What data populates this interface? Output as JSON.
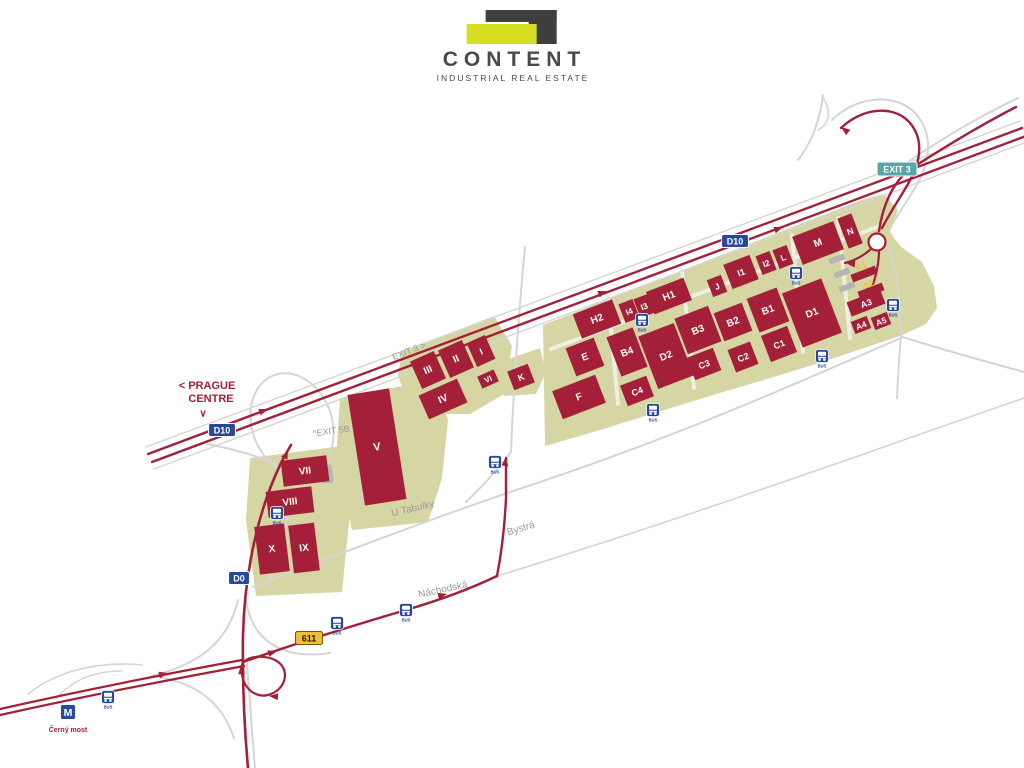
{
  "logo": {
    "title": "CONTENT",
    "subtitle": "INDUSTRIAL REAL ESTATE"
  },
  "colors": {
    "brick": "#a32038",
    "olive": "#d6d5a4",
    "road_gray": "#d5d5d5",
    "road_inner": "#efeee1",
    "blue": "#27499b",
    "teal": "#55a8a8",
    "badge_yellow": "#f3bf30",
    "label_yellow": "#eec43e",
    "gray_building": "#b5b5b5",
    "text_gray": "#9b9b9b",
    "logo_yellow": "#d7df23",
    "logo_dark": "#3f3f3f",
    "text_dark": "#4a4a4a",
    "white": "#ffffff"
  },
  "map": {
    "bus_label": "BUS",
    "parcels": [
      {
        "id": "east-campus",
        "points": "543,325 660,279 780,232 862,200 884,194 898,210 890,232 900,246 922,262 934,286 937,308 926,324 900,336 810,366 690,402 600,430 545,446"
      },
      {
        "id": "k-parcel",
        "points": "500,362 540,348 546,372 536,394 504,396"
      },
      {
        "id": "west-parcel-1",
        "points": "402,352 494,316 512,346 504,394 470,414 412,414 398,376"
      },
      {
        "id": "west-parcel-v",
        "points": "340,398 434,380 448,420 442,478 428,522 352,530 336,460"
      },
      {
        "id": "west-parcel-2",
        "points": "250,458 342,446 350,512 342,592 256,596 246,520"
      }
    ],
    "roads": [
      {
        "id": "campus-inner-1",
        "c": "inner",
        "w": 4,
        "d": "M 551,349 L 880,226"
      },
      {
        "id": "campus-inner-2",
        "c": "inner",
        "w": 4,
        "d": "M 608,297 L 618,404"
      },
      {
        "id": "campus-inner-3",
        "c": "inner",
        "w": 4,
        "d": "M 682,270 L 694,388"
      },
      {
        "id": "campus-inner-4",
        "c": "inner",
        "w": 4,
        "d": "M 792,235 L 803,352"
      },
      {
        "id": "campus-inner-5",
        "c": "inner",
        "w": 4,
        "d": "M 838,218 L 850,338"
      },
      {
        "id": "d10-edge-n",
        "c": "gray",
        "w": 1.4,
        "d": "M 146,447 L 1020,121"
      },
      {
        "id": "d10-edge-s",
        "c": "gray",
        "w": 1.4,
        "d": "M 154,469 L 1024,143"
      },
      {
        "id": "u-tabulky",
        "c": "gray",
        "w": 2,
        "d": "M 253,587 C 380,538 470,505 540,482 C 680,435 800,382 903,337"
      },
      {
        "id": "u-tabulky-east",
        "c": "gray",
        "w": 2,
        "d": "M 903,337 C 943,350 984,361 1024,372"
      },
      {
        "id": "campus-south-branch",
        "c": "gray",
        "w": 2,
        "d": "M 901,336 C 899,357 898,376 897,398"
      },
      {
        "id": "nachodska-ext",
        "c": "gray",
        "w": 1.6,
        "d": "M 497,576 C 680,520 860,455 1024,398"
      },
      {
        "id": "underpass-connector",
        "c": "gray",
        "w": 2,
        "d": "M 525,247 C 518,320 513,400 511,452"
      },
      {
        "id": "junction-link",
        "c": "gray",
        "w": 2,
        "d": "M 511,452 C 497,470 481,488 466,502"
      },
      {
        "id": "west-loop",
        "c": "gray",
        "w": 2,
        "ellipse": [
          292,
          424,
          40,
          52,
          -20
        ]
      },
      {
        "id": "west-loop-south",
        "c": "gray",
        "w": 2,
        "d": "M 297,474 C 290,510 280,548 268,586"
      },
      {
        "id": "west-ramp",
        "c": "gray",
        "w": 2,
        "d": "M 207,444 C 238,450 262,457 281,467"
      },
      {
        "id": "d0-ramp-w",
        "c": "gray",
        "w": 2,
        "d": "M 238,600 C 228,642 200,664 152,676"
      },
      {
        "id": "d0-ramp-sw",
        "c": "gray",
        "w": 2,
        "d": "M 152,676 C 196,682 222,702 234,738"
      },
      {
        "id": "d0-ramp-e",
        "c": "gray",
        "w": 2,
        "d": "M 246,600 C 252,642 284,660 330,653"
      },
      {
        "id": "d0-south-edge",
        "c": "gray",
        "w": 2,
        "d": "M 247,664 C 250,700 252,734 255,768"
      },
      {
        "id": "metro-area-1",
        "c": "gray",
        "w": 1.6,
        "d": "M 28,694 C 58,670 100,661 142,665"
      },
      {
        "id": "metro-area-2",
        "c": "gray",
        "w": 1.6,
        "d": "M 56,699 C 72,680 95,671 122,671"
      },
      {
        "id": "exit3-gray-loop",
        "c": "gray",
        "w": 2,
        "d": "M 832,120 C 864,88 922,92 928,142 C 930,175 908,196 890,228"
      },
      {
        "id": "exit3-gray-ne",
        "c": "gray",
        "w": 2,
        "d": "M 1018,98 C 972,120 937,142 908,162"
      },
      {
        "id": "exit3-gray-n",
        "c": "gray",
        "w": 2,
        "d": "M 823,95 C 820,120 812,142 798,160"
      },
      {
        "id": "exit3-gray-loop2",
        "c": "gray",
        "w": 1.6,
        "d": "M 822,96 C 832,110 830,124 818,130"
      },
      {
        "id": "exit3-gray-s",
        "c": "gray",
        "w": 2,
        "d": "M 888,249 C 894,262 897,275 898,290 C 899,305 900,318 901,333"
      },
      {
        "id": "d10-north",
        "c": "red",
        "w": 2.4,
        "d": "M 148,454 L 1022,128"
      },
      {
        "id": "d10-south",
        "c": "red",
        "w": 2.4,
        "d": "M 152,462 L 1026,136"
      },
      {
        "id": "chlumecka-1",
        "c": "red",
        "w": 2.2,
        "d": "M 0,709 C 80,691 160,675 242,660"
      },
      {
        "id": "chlumecka-2",
        "c": "red",
        "w": 2.2,
        "d": "M 0,715 C 82,697 162,681 244,666"
      },
      {
        "id": "nachodska",
        "c": "red",
        "w": 2.4,
        "d": "M 243,662 C 300,642 355,625 406,610 C 440,600 468,590 497,576"
      },
      {
        "id": "bystra",
        "c": "red",
        "w": 2.4,
        "d": "M 497,576 C 503,545 505,520 506,498 L 506,458"
      },
      {
        "id": "d0-exit5b",
        "c": "red",
        "w": 2.6,
        "d": "M 248,768 C 245,735 243,700 243,662 C 242,622 245,590 251,558 C 258,520 268,490 281,463 C 285,455 288,450 291,445"
      },
      {
        "id": "loop-611",
        "c": "red",
        "w": 2.2,
        "d": "M 243,661 C 237,682 252,699 268,695 C 287,690 291,668 275,660 C 264,655 251,656 245,661"
      },
      {
        "id": "exit3-loop",
        "c": "red",
        "w": 2.4,
        "d": "M 841,128 C 867,103 908,104 918,138 C 925,168 902,190 882,228"
      },
      {
        "id": "exit3-ramp-ne",
        "c": "red",
        "w": 2.4,
        "d": "M 1016,107 C 975,128 940,150 912,168 C 897,178 884,198 879,231"
      },
      {
        "id": "campus-entry-w",
        "c": "red",
        "w": 2.2,
        "d": "M 871,249 C 862,257 853,261 845,263"
      },
      {
        "id": "campus-entry-s",
        "c": "red",
        "w": 2.2,
        "d": "M 879,251 C 879,267 874,282 869,297"
      }
    ],
    "roundabout": {
      "x": 877,
      "y": 242,
      "r": 8.5
    },
    "arrows": [
      {
        "x": 268,
        "y": 409,
        "r": -20.5
      },
      {
        "x": 607,
        "y": 291,
        "r": -20.5
      },
      {
        "x": 783,
        "y": 227,
        "r": -20.5
      },
      {
        "x": 168,
        "y": 673,
        "r": -13
      },
      {
        "x": 277,
        "y": 651,
        "r": -17
      },
      {
        "x": 447,
        "y": 594,
        "r": -14
      },
      {
        "x": 506,
        "y": 457,
        "r": -83
      },
      {
        "x": 241,
        "y": 665,
        "r": -94
      },
      {
        "x": 269,
        "y": 696,
        "r": 185
      },
      {
        "x": 288,
        "y": 450,
        "r": -66
      },
      {
        "x": 841,
        "y": 127,
        "r": 217
      },
      {
        "x": 896,
        "y": 177,
        "r": 155
      },
      {
        "x": 846,
        "y": 263,
        "r": 187
      },
      {
        "x": 869,
        "y": 297,
        "r": 99
      }
    ],
    "gray_buildings": [
      {
        "x": 327,
        "y": 474,
        "w": 11,
        "h": 18,
        "rot": -7
      },
      {
        "x": 831,
        "y": 246,
        "w": 16,
        "h": 6,
        "rot": -21
      },
      {
        "x": 837,
        "y": 259,
        "w": 16,
        "h": 6,
        "rot": -21
      },
      {
        "x": 842,
        "y": 273,
        "w": 16,
        "h": 6,
        "rot": -21
      },
      {
        "x": 847,
        "y": 287,
        "w": 16,
        "h": 6,
        "rot": -21
      }
    ],
    "buildings": [
      {
        "label": "H2",
        "x": 597,
        "y": 319,
        "w": 42,
        "h": 26,
        "rot": -21,
        "fs": 10
      },
      {
        "label": "I4",
        "x": 629,
        "y": 311,
        "w": 15,
        "h": 20,
        "rot": -21,
        "fs": 8.5
      },
      {
        "label": "I3",
        "x": 644,
        "y": 306,
        "w": 15,
        "h": 20,
        "rot": -21,
        "fs": 8.5
      },
      {
        "label": "H1",
        "x": 669,
        "y": 296,
        "w": 40,
        "h": 24,
        "rot": -21,
        "fs": 10
      },
      {
        "label": "J",
        "x": 717,
        "y": 286,
        "w": 15,
        "h": 18,
        "rot": -21,
        "fs": 8.5
      },
      {
        "label": "I1",
        "x": 741,
        "y": 272,
        "w": 28,
        "h": 26,
        "rot": -21,
        "fs": 9
      },
      {
        "label": "I2",
        "x": 766,
        "y": 263,
        "w": 15,
        "h": 20,
        "rot": -21,
        "fs": 8.5
      },
      {
        "label": "L",
        "x": 783,
        "y": 257,
        "w": 15,
        "h": 20,
        "rot": -21,
        "fs": 8.5
      },
      {
        "label": "M",
        "x": 818,
        "y": 243,
        "w": 44,
        "h": 30,
        "rot": -21,
        "fs": 10
      },
      {
        "label": "N",
        "x": 850,
        "y": 231,
        "w": 15,
        "h": 32,
        "rot": -21,
        "fs": 9
      },
      {
        "label": "E",
        "x": 585,
        "y": 357,
        "w": 30,
        "h": 30,
        "rot": -21,
        "fs": 10
      },
      {
        "label": "B4",
        "x": 627,
        "y": 352,
        "w": 28,
        "h": 42,
        "rot": -21,
        "fs": 10
      },
      {
        "label": "D2",
        "x": 666,
        "y": 356,
        "w": 38,
        "h": 56,
        "rot": -21,
        "fs": 10
      },
      {
        "label": "B3",
        "x": 698,
        "y": 330,
        "w": 36,
        "h": 38,
        "rot": -21,
        "fs": 10
      },
      {
        "label": "B2",
        "x": 733,
        "y": 322,
        "w": 30,
        "h": 30,
        "rot": -21,
        "fs": 10
      },
      {
        "label": "B1",
        "x": 768,
        "y": 310,
        "w": 32,
        "h": 36,
        "rot": -21,
        "fs": 10
      },
      {
        "label": "D1",
        "x": 812,
        "y": 313,
        "w": 42,
        "h": 58,
        "rot": -21,
        "fs": 10
      },
      {
        "label": "C4",
        "x": 637,
        "y": 391,
        "w": 28,
        "h": 22,
        "rot": -21,
        "fs": 9
      },
      {
        "label": "C3",
        "x": 704,
        "y": 364,
        "w": 28,
        "h": 24,
        "rot": -21,
        "fs": 9
      },
      {
        "label": "C2",
        "x": 743,
        "y": 357,
        "w": 24,
        "h": 24,
        "rot": -21,
        "fs": 9
      },
      {
        "label": "C1",
        "x": 779,
        "y": 344,
        "w": 28,
        "h": 28,
        "rot": -21,
        "fs": 9
      },
      {
        "label": "F",
        "x": 579,
        "y": 397,
        "w": 46,
        "h": 30,
        "rot": -21,
        "fs": 10
      },
      {
        "label": "K",
        "x": 521,
        "y": 377,
        "w": 22,
        "h": 20,
        "rot": -21,
        "fs": 9
      },
      {
        "label": "A1",
        "x": 864,
        "y": 274,
        "w": 26,
        "h": 8,
        "rot": -21,
        "fs": 9,
        "lc": "label_yellow",
        "dy": -8
      },
      {
        "label": "A2",
        "x": 871,
        "y": 291,
        "w": 26,
        "h": 8,
        "rot": -21,
        "fs": 9,
        "lc": "label_yellow",
        "dy": -7
      },
      {
        "label": "A3",
        "x": 866,
        "y": 303,
        "w": 36,
        "h": 15,
        "rot": -21,
        "fs": 9
      },
      {
        "label": "A4",
        "x": 861,
        "y": 325,
        "w": 17,
        "h": 13,
        "rot": -21,
        "fs": 8.5
      },
      {
        "label": "A5",
        "x": 881,
        "y": 321,
        "w": 17,
        "h": 13,
        "rot": -21,
        "fs": 8.5
      },
      {
        "label": "I",
        "x": 481,
        "y": 351,
        "w": 20,
        "h": 26,
        "rot": -24,
        "fs": 9
      },
      {
        "label": "II",
        "x": 456,
        "y": 359,
        "w": 26,
        "h": 30,
        "rot": -24,
        "fs": 10
      },
      {
        "label": "III",
        "x": 428,
        "y": 370,
        "w": 26,
        "h": 30,
        "rot": -24,
        "fs": 10
      },
      {
        "label": "VI",
        "x": 488,
        "y": 379,
        "w": 18,
        "h": 13,
        "rot": -24,
        "fs": 8
      },
      {
        "label": "IV",
        "x": 443,
        "y": 399,
        "w": 42,
        "h": 26,
        "rot": -24,
        "fs": 10
      },
      {
        "label": "V",
        "x": 377,
        "y": 447,
        "w": 42,
        "h": 112,
        "rot": -9,
        "fs": 11
      },
      {
        "label": "VII",
        "x": 305,
        "y": 471,
        "w": 46,
        "h": 26,
        "rot": -7,
        "fs": 10
      },
      {
        "label": "VIII",
        "x": 290,
        "y": 502,
        "w": 46,
        "h": 26,
        "rot": -7,
        "fs": 10
      },
      {
        "label": "X",
        "x": 272,
        "y": 549,
        "w": 30,
        "h": 48,
        "rot": -7,
        "fs": 10
      },
      {
        "label": "IX",
        "x": 304,
        "y": 548,
        "w": 26,
        "h": 48,
        "rot": -7,
        "fs": 10
      }
    ],
    "badges": [
      {
        "text": "D10",
        "x": 222,
        "y": 430,
        "type": "motorway"
      },
      {
        "text": "D10",
        "x": 735,
        "y": 241,
        "type": "motorway"
      },
      {
        "text": "D0",
        "x": 239,
        "y": 578,
        "type": "motorway"
      },
      {
        "text": "611",
        "x": 309,
        "y": 638,
        "type": "route"
      },
      {
        "text": "EXIT 3",
        "x": 897,
        "y": 169,
        "type": "exit"
      }
    ],
    "bus_stops": [
      {
        "x": 108,
        "y": 697
      },
      {
        "x": 337,
        "y": 623
      },
      {
        "x": 406,
        "y": 610
      },
      {
        "x": 495,
        "y": 462
      },
      {
        "x": 277,
        "y": 513
      },
      {
        "x": 642,
        "y": 320
      },
      {
        "x": 653,
        "y": 410
      },
      {
        "x": 796,
        "y": 273
      },
      {
        "x": 893,
        "y": 305
      },
      {
        "x": 822,
        "y": 356
      }
    ],
    "metro": {
      "x": 68,
      "y": 712,
      "label": "M",
      "caption": "Černý most"
    },
    "labels": [
      {
        "t": "<  PRAGUE",
        "x": 207,
        "y": 386,
        "c": "brick",
        "fs": 11,
        "b": 1
      },
      {
        "t": "CENTRE",
        "x": 211,
        "y": 399,
        "c": "brick",
        "fs": 11,
        "b": 1
      },
      {
        "t": "∨",
        "x": 203,
        "y": 414,
        "c": "brick",
        "fs": 10,
        "b": 1
      },
      {
        "t": "EXIT 3 >",
        "x": 409,
        "y": 351,
        "c": "gray",
        "fs": 9,
        "r": -21
      },
      {
        "t": "^EXIT 5B",
        "x": 331,
        "y": 431,
        "c": "gray",
        "fs": 9,
        "r": -8
      },
      {
        "t": "U Tabulky",
        "x": 413,
        "y": 509,
        "c": "gray",
        "fs": 10,
        "r": -13
      },
      {
        "t": "Bystrá",
        "x": 521,
        "y": 529,
        "c": "gray",
        "fs": 10,
        "r": -17
      },
      {
        "t": "Náchodská",
        "x": 443,
        "y": 590,
        "c": "gray",
        "fs": 10,
        "r": -12
      }
    ]
  }
}
